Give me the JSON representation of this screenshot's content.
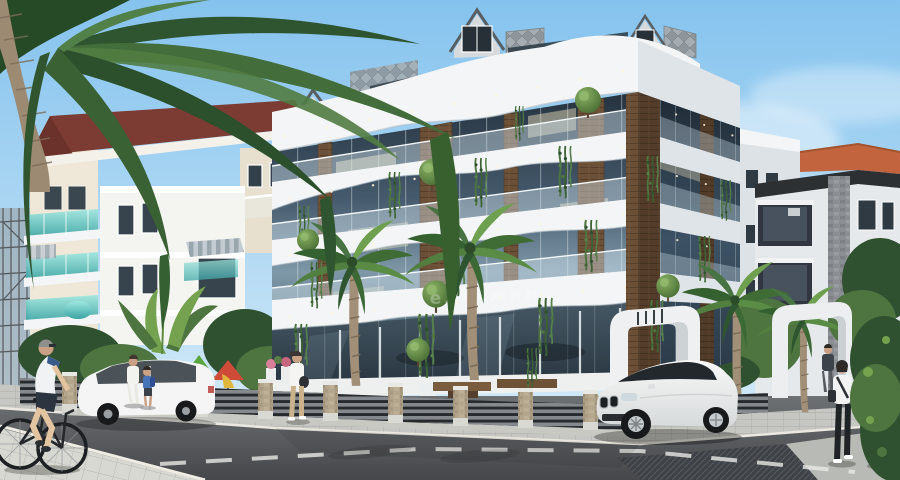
{
  "meta": {
    "title": "Architectural exterior render — modern residential complex",
    "style": "photoreal 3D visualization, street-corner view"
  },
  "watermark": {
    "text": "едвижим"
  },
  "colors": {
    "sky_top": "#85c3ee",
    "sky_horizon": "#dff0fb",
    "cloud": "#ffffff",
    "main_white": "#f3f5f6",
    "fascia_shade": "#dfe4e9",
    "glass_dark": "#26333f",
    "glass_mid": "#5b7689",
    "glass_light": "#9fb7c4",
    "wood": "#6b4f36",
    "cream": "#efe8d8",
    "roof_maroon": "#7c3b33",
    "teal": "#56c5c3",
    "gray_facade": "#dde2e7",
    "terracotta": "#c2653e",
    "stone": "#b4a68c",
    "road": "#54575a",
    "sidewalk": "#c6c7c2",
    "crosswalk": "#d8d8d2",
    "lane_mark": "#e8e9e6",
    "fence_slat": "#85898d",
    "fence_dark": "#272b2e",
    "foliage_dark": "#2f5130",
    "foliage_mid": "#4e7540",
    "foliage_light": "#74a24e",
    "canopy_red": "#cf4b38",
    "canopy_green": "#5aa53f",
    "car_white": "#f4f5f4",
    "tire": "#17191b",
    "skin": "#caa184",
    "shadow": "#1e2124"
  },
  "scene": {
    "buildings": [
      {
        "id": "main-residence",
        "label": "modern apartment building with wavy white balcony bands, wood piers, glass facade, roof dormers",
        "floors_visible": 4
      },
      {
        "id": "left-apartments",
        "label": "cream apartment block with dark-red tiled roof and turquoise glass balconies"
      },
      {
        "id": "left-background",
        "label": "white low-rise building with striped awning"
      },
      {
        "id": "construction-scaffold",
        "label": "scaffolded building under construction at far left"
      },
      {
        "id": "right-gray-block",
        "label": "light gray flat-roof apartment block"
      },
      {
        "id": "right-terracotta",
        "label": "apartment block with terracotta roof, dark balconies and stone-clad column"
      }
    ],
    "street": {
      "elements": [
        "asphalt road",
        "dashed lane markings",
        "corner sidewalk with paver tiles",
        "pedestrian crossing tiles bottom-left",
        "dark tactile crossing pad bottom-right",
        "perimeter fence with stone pillars and gray slats",
        "two white sculptural entrance gates",
        "playground with green and red cone canopies",
        "wooden deck seating",
        "flower planters"
      ]
    },
    "vehicles": [
      {
        "id": "white-suv",
        "label": "white luxury SUV parked at curb"
      },
      {
        "id": "white-wagon",
        "label": "white estate car on left street"
      }
    ],
    "people": [
      "senior cyclist riding bicycle",
      "woman crossing at the corner",
      "man walking with child",
      "child with blue backpack",
      "man standing at entrance gate",
      "two women walking away on right sidewalk"
    ],
    "vegetation": [
      "large foreground palm overhanging from top-left",
      "street palms inside the yard",
      "hanging ivy on balconies",
      "spherical topiary shrubs",
      "banana plants",
      "dense hedges and trees"
    ]
  }
}
